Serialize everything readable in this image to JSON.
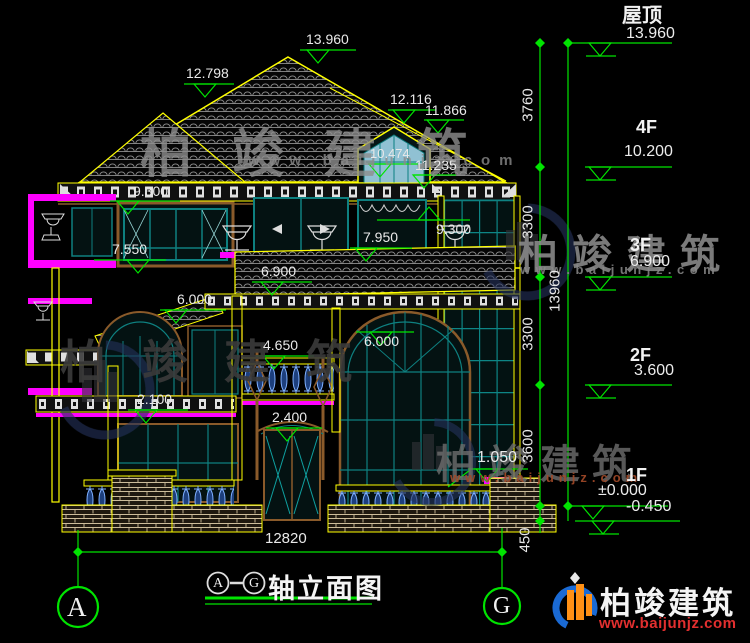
{
  "drawing": {
    "title": {
      "axis_from": "A",
      "axis_to": "G",
      "name": "轴立面图"
    },
    "axes": {
      "left": "A",
      "right": "G"
    },
    "levels": [
      {
        "label": "屋顶",
        "elevation": "13.960"
      },
      {
        "label": "4F",
        "elevation": "10.200"
      },
      {
        "label": "3F",
        "elevation": "6.900"
      },
      {
        "label": "2F",
        "elevation": "3.600"
      },
      {
        "label": "1F",
        "elevation": "±0.000"
      },
      {
        "label": "",
        "elevation": "-0.450"
      }
    ],
    "vertical_dims": {
      "seg1": "3760",
      "seg2": "3300",
      "seg3": "3300",
      "seg4": "3600",
      "seg5": "450",
      "overall": "13960"
    },
    "dims": {
      "main_ridge": "13.960",
      "left_ridge": "12.798",
      "right_ridge": "12.116",
      "right_roof_edge": "11.866",
      "dormer_window": "10.474",
      "dormer_eave": "11.235",
      "eave_left": "9.300",
      "eave_right": "9.300",
      "parapet_left": "7.550",
      "parapet_center": "7.950",
      "canopy_eave": "6.900",
      "canopy_left_eave": "6.000",
      "arch_window_top": "6.000",
      "balcony_rail": "4.650",
      "door_head": "2.400",
      "porch_band": "2.100",
      "sill_right": "1.050",
      "overall_width": "12820"
    }
  },
  "watermarks": {
    "brand": "柏竣建筑",
    "site": "www.baijunjz.com"
  },
  "logo": {
    "brand": "柏竣建筑",
    "site": "www.baijunjz.com"
  },
  "colors": {
    "dimension_green": "#00e400",
    "outline_yellow": "#ffff00",
    "window_teal": "#0e8080",
    "accent_magenta": "#ff00ff",
    "frame_brown": "#8a5a2a",
    "text_white": "#e9e9e9",
    "logo_blue": "#1a6ad4",
    "logo_orange": "#ff9015",
    "logo_red": "#e22f2f"
  }
}
